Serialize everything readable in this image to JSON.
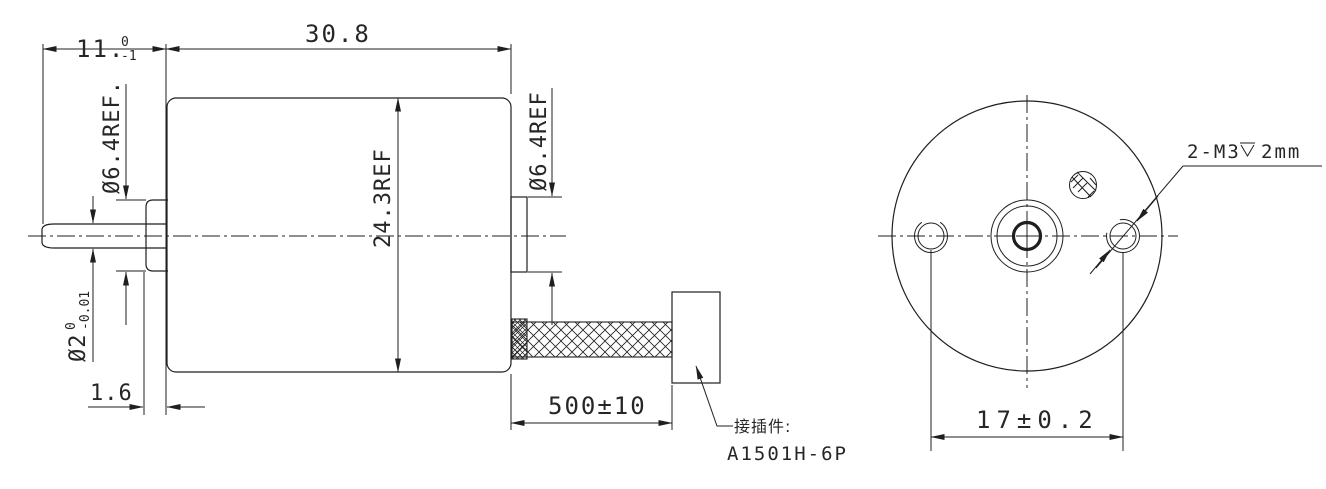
{
  "colors": {
    "background": "#ffffff",
    "line": "#1f1f1f",
    "text": "#262626"
  },
  "side_view": {
    "dims": {
      "shaft_ext_length": {
        "main": "11.",
        "tol_upper": "0",
        "tol_lower": "-1"
      },
      "body_length": "30.8",
      "front_boss_dia": "Ø6.4REF.",
      "body_dia": "24.3REF",
      "rear_boss_dia": "Ø6.4REF",
      "shaft_dia": {
        "main": "Ø2",
        "tol_upper": "0",
        "tol_lower": "-0.01"
      },
      "front_boss_length": "1.6",
      "lead_wire_length": "500±10"
    },
    "connector_note": {
      "label": "接插件:",
      "part_number": "A1501H-6P"
    }
  },
  "end_view": {
    "dims": {
      "mounting_hole_spacing": "17±0.2",
      "mounting_hole_spec": {
        "prefix": "2-M3",
        "symbol": "depth-symbol",
        "depth": "2mm"
      }
    }
  }
}
